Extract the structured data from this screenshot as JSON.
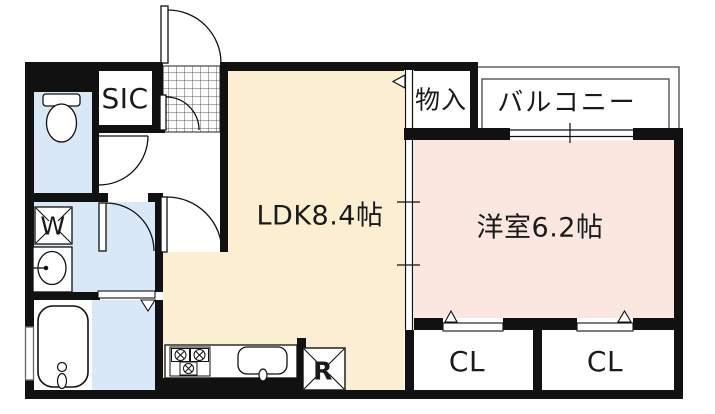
{
  "floorplan": {
    "rooms": {
      "sic": {
        "label": "SIC"
      },
      "storage": {
        "label": "物入"
      },
      "balcony": {
        "label": "バルコニー"
      },
      "ldk": {
        "label": "LDK8.4帖"
      },
      "western_room": {
        "label": "洋室6.2帖"
      },
      "closet_left": {
        "label": "CL"
      },
      "closet_right": {
        "label": "CL"
      }
    },
    "fixtures": {
      "washer": {
        "label": "W"
      },
      "refrigerator": {
        "label": "R"
      }
    },
    "colors": {
      "wall": "#111111",
      "wet_area_blue": "#d8e8f6",
      "ldk_cream": "#fcefd1",
      "western_pink": "#fae8e0",
      "outline_gray": "#555555"
    }
  }
}
